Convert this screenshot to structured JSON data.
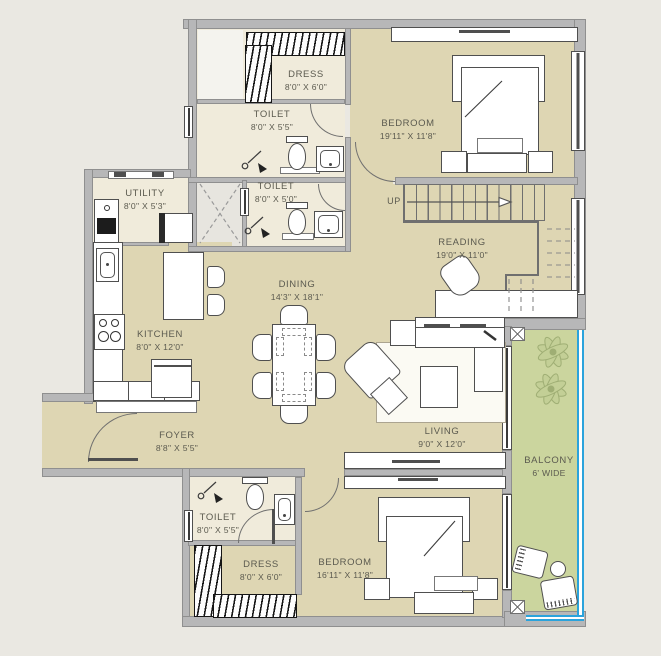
{
  "colors": {
    "background": "#eae8e2",
    "floor_main": "#ded6b3",
    "floor_wet": "#f0ebdb",
    "floor_shaft": "#e7e5df",
    "balcony": "#cbd59e",
    "wall": "#b7b7b8",
    "wall_edge": "#8f8f8f",
    "furniture": "#ffffff",
    "railing": "#2aa3dc",
    "text": "#5b5a4f",
    "plant": "#9fae74"
  },
  "rooms": {
    "dress_top": {
      "label": "DRESS",
      "dims": "8'0\" X 6'0\""
    },
    "toilet_top": {
      "label": "TOILET",
      "dims": "8'0\" X 5'5\""
    },
    "bedroom_top": {
      "label": "BEDROOM",
      "dims": "19'11\" X 11'8\""
    },
    "toilet_mid": {
      "label": "TOILET",
      "dims": "8'0\" X 5'0\""
    },
    "utility": {
      "label": "UTILITY",
      "dims": "8'0\" X 5'3\""
    },
    "reading": {
      "label": "READING",
      "dims": "19'0\" X 11'0\""
    },
    "dining": {
      "label": "DINING",
      "dims": "14'3\" X 18'1\""
    },
    "kitchen": {
      "label": "KITCHEN",
      "dims": "8'0\" X 12'0\""
    },
    "living": {
      "label": "LIVING",
      "dims": "9'0\" X 12'0\""
    },
    "foyer": {
      "label": "FOYER",
      "dims": "8'8\" X 5'5\""
    },
    "toilet_bottom": {
      "label": "TOILET",
      "dims": "8'0\" X 5'5\""
    },
    "dress_bottom": {
      "label": "DRESS",
      "dims": "8'0\" X 6'0\""
    },
    "bedroom_bottom": {
      "label": "BEDROOM",
      "dims": "16'11\" X 11'8\""
    },
    "balcony": {
      "label": "BALCONY",
      "dims": "6' WIDE"
    }
  },
  "stairs": {
    "up_label": "UP"
  }
}
